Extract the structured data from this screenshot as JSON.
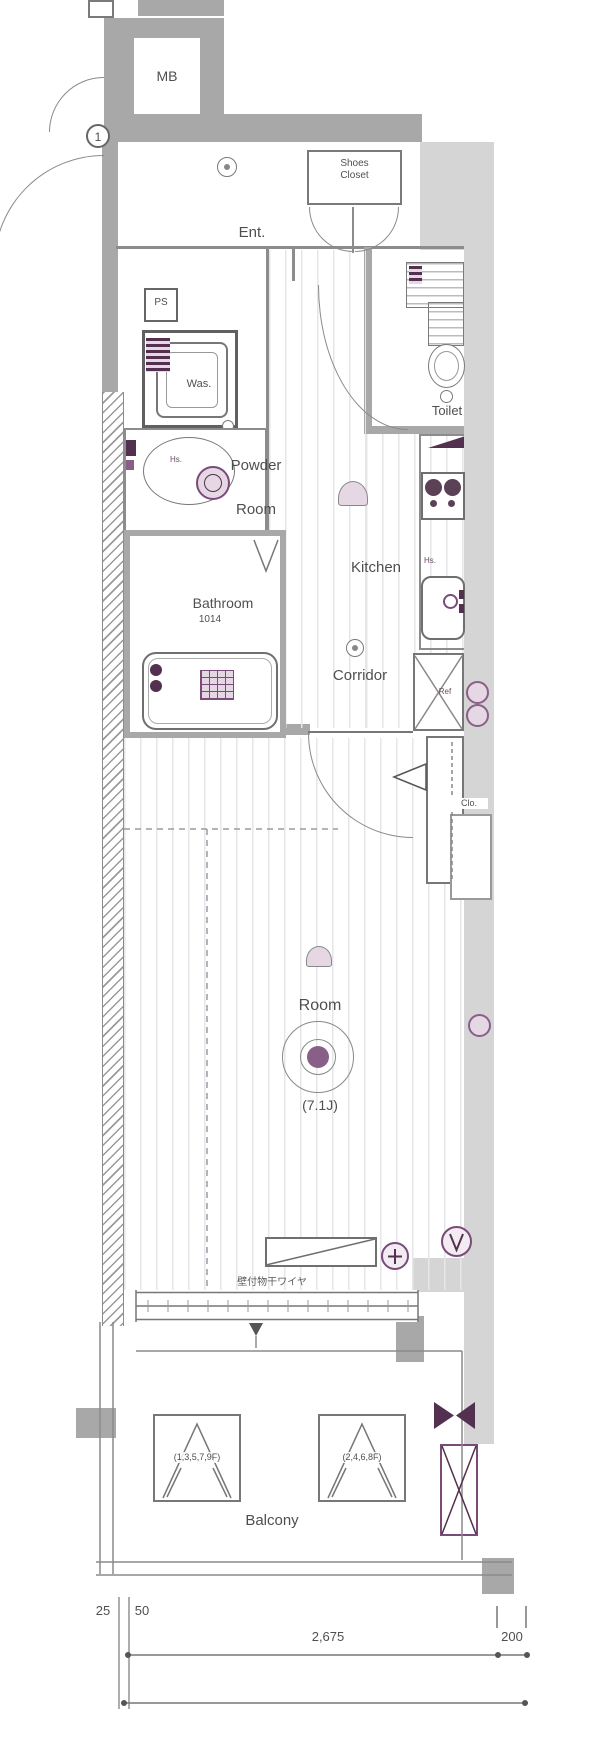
{
  "colors": {
    "wall": "#a8a8a8",
    "wall-dark": "#8c8c8c",
    "light": "#d5d5d5",
    "line": "#707070",
    "accent": "#53304f",
    "accent-mid": "#8a5f87",
    "accent-light": "#e6d7e5",
    "text": "#4f4f4f"
  },
  "rooms": {
    "mb": "MB",
    "entrance": "Ent.",
    "shoes_closet": "Shoes\nCloset",
    "ps": "PS",
    "washer": "Was.",
    "powder_room": "Powder\nRoom",
    "toilet": "Toilet",
    "kitchen": "Kitchen",
    "bathroom": "Bathroom",
    "bathroom_size": "1014",
    "corridor": "Corridor",
    "fridge": "Ref",
    "closet": "Clo.",
    "main_room": "Room",
    "main_room_size": "(7.1J)",
    "balcony": "Balcony"
  },
  "labels": {
    "entry_marker": "1",
    "hot_water_powder": "Hs.",
    "hot_water_kitchen": "Hs.",
    "laundry_wire": "壁付物干ワイヤ",
    "louver_left_floors": "(1,3,5,7,9F)",
    "louver_right_floors": "(2,4,6,8F)"
  },
  "dimensions": {
    "left_offset": "25",
    "left_wall": "50",
    "main_width": "2,675",
    "right_width": "200"
  }
}
